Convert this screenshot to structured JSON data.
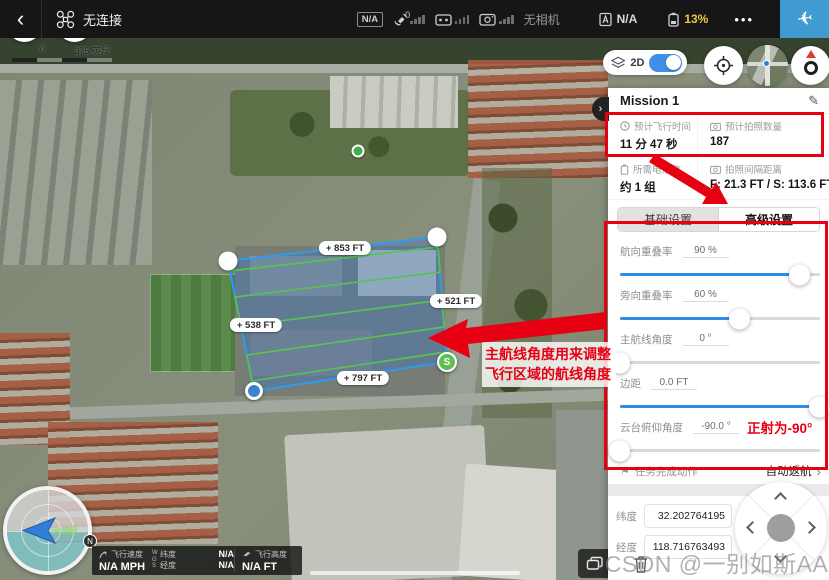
{
  "topbar": {
    "device_status": "无连接",
    "gps_mode": "N/A",
    "satellite_count": "0",
    "camera_status": "无相机",
    "flight_mode_value": "N/A",
    "battery_percent": "13%",
    "accent_color": "#3f9bd0"
  },
  "icons": {
    "back": "‹",
    "more": "•••",
    "edit": "✎",
    "gear": "⚙",
    "flag": "⚑",
    "chevron_right": "›",
    "plane": "✈"
  },
  "map": {
    "scale_start": "0",
    "scale_end": "375 英尺",
    "view_mode": "2D",
    "start_marker": "S",
    "compass_north": "N",
    "edge_labels": {
      "top": "+ 853 FT",
      "right": "+ 521 FT",
      "left": "+ 538 FT",
      "bottom": "+ 797 FT"
    }
  },
  "annotations": {
    "color": "#e60012",
    "route_angle_note": "主航线角度用来调整飞行区域的航线角度",
    "gimbal_note": "正射为-90°"
  },
  "panel": {
    "title": "Mission 1",
    "stats": [
      {
        "label": "预计飞行时间",
        "value": "11 分 47 秒"
      },
      {
        "label": "预计拍照数量",
        "value": "187"
      },
      {
        "label": "所需电池数",
        "value": "约 1 组"
      },
      {
        "label": "拍照间隔距离",
        "value": "F: 21.3 FT / S: 113.6 FT"
      }
    ],
    "tabs": [
      {
        "label": "基础设置",
        "active": false
      },
      {
        "label": "高级设置",
        "active": true
      }
    ],
    "sliders": [
      {
        "label": "航向重叠率",
        "value": "90 %",
        "percent": 90
      },
      {
        "label": "旁向重叠率",
        "value": "60 %",
        "percent": 60
      },
      {
        "label": "主航线角度",
        "value": "0 °",
        "percent": 0
      },
      {
        "label": "边距",
        "value": "0.0 FT",
        "percent": 100
      },
      {
        "label": "云台俯仰角度",
        "value": "-90.0 °",
        "percent": 0
      }
    ],
    "finish_action_label": "任务完成动作",
    "finish_action_value": "自动返航",
    "latitude_label": "纬度",
    "latitude_value": "32.202764195",
    "longitude_label": "经度",
    "longitude_value": "118.716763493"
  },
  "telemetry": {
    "speed_label": "飞行速度",
    "speed_value": "N/A MPH",
    "datum": "WGS",
    "lat_label": "纬度",
    "lat_value": "N/A",
    "lng_label": "经度",
    "lng_value": "N/A",
    "alt_label": "飞行高度",
    "alt_value": "N/A FT"
  },
  "watermark": "CSDN @一别如斯AA"
}
